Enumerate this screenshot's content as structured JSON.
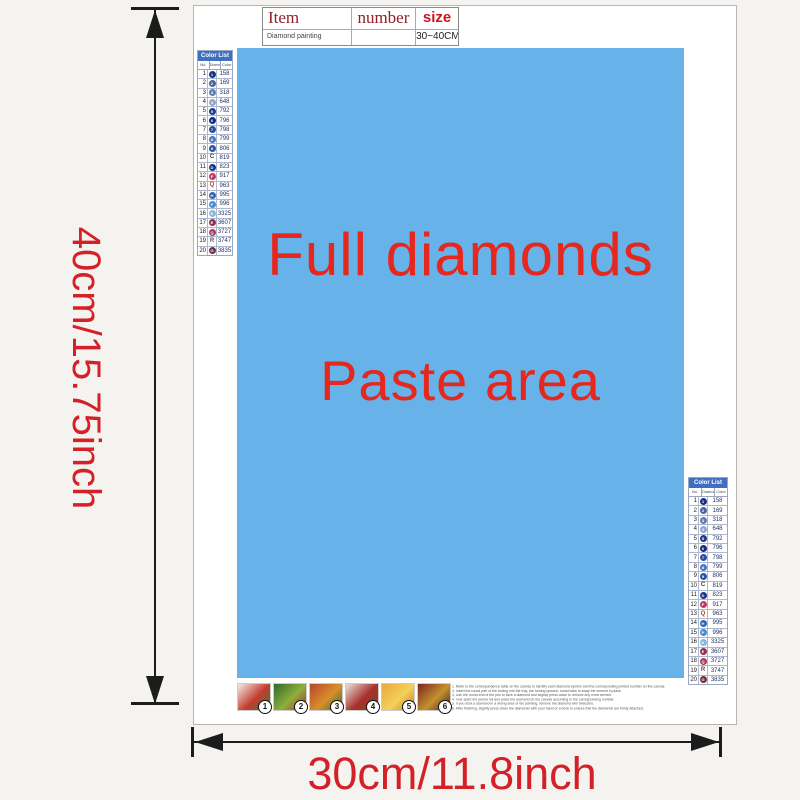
{
  "page": {
    "bg_color": "#f4f3f0"
  },
  "item_table": {
    "col_item": "Item",
    "col_number": "number",
    "col_size": "size",
    "header_color": "#8e2228",
    "size_header_color": "#cc1520",
    "row_item": "Diamond painting",
    "row_number": "",
    "row_size": "30~40CM"
  },
  "paste_area": {
    "line1": "Full diamonds",
    "line2": "Paste area",
    "bg_color": "#67b2e8",
    "text_color": "#e5271d"
  },
  "dimension_labels": {
    "height": "40cm/15.75inch",
    "width": "30cm/11.8inch",
    "color": "#d32127"
  },
  "color_list": {
    "title": "Color List",
    "title_bg": "#3f6fbe",
    "columns": [
      "No.",
      "Diamond",
      "Color"
    ],
    "rows": [
      {
        "no": "1",
        "code": "158",
        "symbol": "1",
        "type": "circle",
        "color": "#16337f"
      },
      {
        "no": "2",
        "code": "169",
        "symbol": "2",
        "type": "circle",
        "color": "#49659e"
      },
      {
        "no": "3",
        "code": "318",
        "symbol": "3",
        "type": "circle",
        "color": "#5e7db0"
      },
      {
        "no": "4",
        "code": "648",
        "symbol": "4",
        "type": "circle",
        "color": "#93a7c9"
      },
      {
        "no": "5",
        "code": "792",
        "symbol": "5",
        "type": "circle",
        "color": "#1d3a8e"
      },
      {
        "no": "6",
        "code": "796",
        "symbol": "6",
        "type": "circle",
        "color": "#122c7d"
      },
      {
        "no": "7",
        "code": "798",
        "symbol": "7",
        "type": "circle",
        "color": "#2a4d9f"
      },
      {
        "no": "8",
        "code": "799",
        "symbol": "8",
        "type": "circle",
        "color": "#4a74c4"
      },
      {
        "no": "9",
        "code": "806",
        "symbol": "9",
        "type": "circle",
        "color": "#2e55a5"
      },
      {
        "no": "10",
        "code": "819",
        "symbol": "C",
        "type": "letter",
        "color": "#333333"
      },
      {
        "no": "11",
        "code": "823",
        "symbol": "D",
        "type": "circle",
        "color": "#1b2f86"
      },
      {
        "no": "12",
        "code": "917",
        "symbol": "F",
        "type": "circle",
        "color": "#c13a6a"
      },
      {
        "no": "13",
        "code": "963",
        "symbol": "Q",
        "type": "letter",
        "color": "#a8402e"
      },
      {
        "no": "14",
        "code": "995",
        "symbol": "H",
        "type": "circle",
        "color": "#2f62b5"
      },
      {
        "no": "15",
        "code": "996",
        "symbol": "P",
        "type": "circle",
        "color": "#3f8ed6"
      },
      {
        "no": "16",
        "code": "3325",
        "symbol": "K",
        "type": "circle",
        "color": "#85b7e3"
      },
      {
        "no": "17",
        "code": "3607",
        "symbol": "E",
        "type": "circle",
        "color": "#8e3050"
      },
      {
        "no": "18",
        "code": "3727",
        "symbol": "Q",
        "type": "circle",
        "color": "#a63a5c"
      },
      {
        "no": "19",
        "code": "3747",
        "symbol": "R",
        "type": "letter",
        "color": "#555555"
      },
      {
        "no": "20",
        "code": "3835",
        "symbol": "G",
        "type": "circle",
        "color": "#6e2f42"
      }
    ]
  },
  "steps": [
    {
      "label": "1",
      "colors": [
        "#f2efe8",
        "#c43b2e",
        "#3f7a33"
      ]
    },
    {
      "label": "2",
      "colors": [
        "#2e6b2a",
        "#8fae3c",
        "#a83326"
      ]
    },
    {
      "label": "3",
      "colors": [
        "#b5452a",
        "#d98f2b",
        "#3d6e2e"
      ]
    },
    {
      "label": "4",
      "colors": [
        "#e8e4da",
        "#a8302c",
        "#7a4a22"
      ]
    },
    {
      "label": "5",
      "colors": [
        "#e8a93c",
        "#f4d05a",
        "#c97f22"
      ]
    },
    {
      "label": "6",
      "colors": [
        "#7a2420",
        "#c4922e",
        "#4a1f1a"
      ]
    }
  ],
  "instructions": [
    "1. Refer to the correspondence table on the canvas to identify each diamond symbol and the corresponding printed number on the canvas.",
    "2. Insert the round part of the tooling into the tray, the turning upward, round back to sway the cement in place.",
    "3. Use the round end of the pen to stick a diamond and slightly press down to remove any extra cement.",
    "4. Tear apart the period foil and place the diamond on the canvas according to the corresponding number.",
    "5. If you stick a diamond in a wrong area of the painting, remove the diamond with tweezers.",
    "6. After finishing, slightly press down the diamonds with your hand or a book to ensure that the diamonds are firmly attached."
  ]
}
